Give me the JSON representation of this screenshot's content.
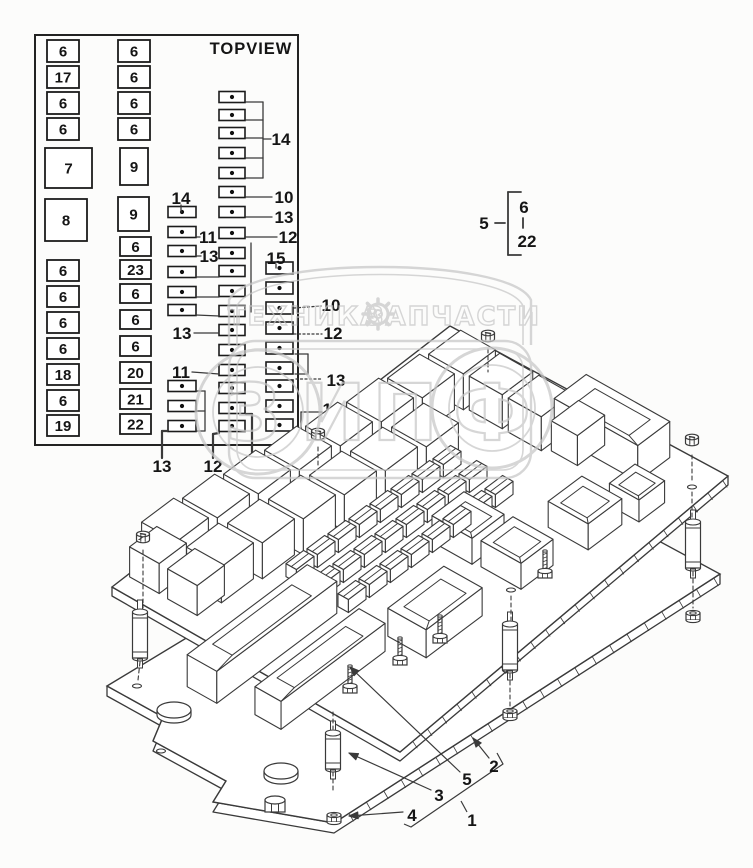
{
  "colors": {
    "bg": "#fcfcfb",
    "line": "#3a3a3a",
    "ink": "#151515",
    "watermark": "#c7c7c7"
  },
  "topview": {
    "title": "TOPVIEW",
    "panel": [
      35,
      35,
      263,
      410
    ],
    "boxes": [
      [
        "6",
        47,
        40,
        32,
        22
      ],
      [
        "17",
        47,
        66,
        32,
        22
      ],
      [
        "6",
        47,
        92,
        32,
        22
      ],
      [
        "6",
        47,
        118,
        32,
        22
      ],
      [
        "7",
        45,
        148,
        47,
        40
      ],
      [
        "8",
        45,
        199,
        42,
        42
      ],
      [
        "6",
        47,
        260,
        32,
        21
      ],
      [
        "6",
        47,
        286,
        32,
        21
      ],
      [
        "6",
        47,
        312,
        32,
        21
      ],
      [
        "6",
        47,
        338,
        32,
        21
      ],
      [
        "18",
        47,
        364,
        32,
        21
      ],
      [
        "6",
        47,
        390,
        32,
        21
      ],
      [
        "19",
        47,
        415,
        32,
        21
      ],
      [
        "6",
        118,
        40,
        32,
        22
      ],
      [
        "6",
        118,
        66,
        32,
        22
      ],
      [
        "6",
        118,
        92,
        32,
        22
      ],
      [
        "6",
        118,
        118,
        32,
        22
      ],
      [
        "9",
        120,
        148,
        28,
        37
      ],
      [
        "9",
        118,
        197,
        31,
        34
      ],
      [
        "6",
        120,
        237,
        31,
        19
      ],
      [
        "23",
        120,
        260,
        31,
        19
      ],
      [
        "6",
        120,
        284,
        31,
        19
      ],
      [
        "6",
        120,
        310,
        31,
        19
      ],
      [
        "6",
        120,
        336,
        31,
        20
      ],
      [
        "20",
        120,
        362,
        31,
        21
      ],
      [
        "21",
        120,
        389,
        31,
        20
      ],
      [
        "22",
        120,
        414,
        31,
        20
      ]
    ],
    "fuses": [
      [
        219,
        97,
        26,
        11
      ],
      [
        219,
        115,
        26,
        11
      ],
      [
        219,
        133,
        26,
        11
      ],
      [
        219,
        153,
        26,
        11
      ],
      [
        219,
        173,
        26,
        11
      ],
      [
        219,
        192,
        26,
        11
      ],
      [
        219,
        212,
        26,
        11
      ],
      [
        219,
        233,
        26,
        11
      ],
      [
        219,
        253,
        26,
        11
      ],
      [
        219,
        271,
        26,
        11
      ],
      [
        219,
        291,
        26,
        11
      ],
      [
        219,
        311,
        26,
        11
      ],
      [
        219,
        330,
        26,
        11
      ],
      [
        219,
        350,
        26,
        11
      ],
      [
        219,
        370,
        26,
        11
      ],
      [
        219,
        388,
        26,
        11
      ],
      [
        219,
        408,
        26,
        11
      ],
      [
        219,
        426,
        26,
        11
      ],
      [
        168,
        212,
        28,
        11
      ],
      [
        168,
        232,
        28,
        11
      ],
      [
        168,
        251,
        28,
        11
      ],
      [
        168,
        272,
        28,
        11
      ],
      [
        168,
        292,
        28,
        11
      ],
      [
        168,
        310,
        28,
        11
      ],
      [
        168,
        386,
        28,
        11
      ],
      [
        168,
        406,
        28,
        11
      ],
      [
        168,
        426,
        28,
        11
      ],
      [
        266,
        268,
        27,
        12
      ],
      [
        266,
        288,
        27,
        12
      ],
      [
        266,
        308,
        27,
        12
      ],
      [
        266,
        328,
        27,
        12
      ],
      [
        266,
        348,
        27,
        12
      ],
      [
        266,
        368,
        27,
        12
      ],
      [
        266,
        386,
        27,
        12
      ],
      [
        266,
        406,
        27,
        12
      ],
      [
        266,
        425,
        27,
        12
      ]
    ],
    "labels": [
      [
        "14",
        281,
        139
      ],
      [
        "10",
        284,
        197
      ],
      [
        "13",
        284,
        217
      ],
      [
        "14",
        181,
        198
      ],
      [
        "11",
        208,
        237
      ],
      [
        "12",
        288,
        237
      ],
      [
        "13",
        209,
        256
      ],
      [
        "15",
        276,
        258
      ],
      [
        "10",
        331,
        305
      ],
      [
        "12",
        333,
        333
      ],
      [
        "13",
        182,
        333
      ],
      [
        "11",
        181,
        372
      ],
      [
        "13",
        336,
        380
      ],
      [
        "16",
        332,
        409
      ],
      [
        "13",
        162,
        466
      ],
      [
        "12",
        213,
        466
      ],
      [
        "14",
        252,
        466
      ]
    ],
    "lines_solid": [
      [
        246,
        102,
        263,
        102
      ],
      [
        246,
        120,
        263,
        120
      ],
      [
        246,
        138,
        263,
        138
      ],
      [
        246,
        158,
        263,
        158
      ],
      [
        246,
        178,
        263,
        178
      ],
      [
        263,
        102,
        263,
        178
      ],
      [
        263,
        139,
        271,
        139
      ],
      [
        246,
        197,
        272,
        197
      ],
      [
        246,
        217,
        272,
        217
      ],
      [
        181,
        205,
        181,
        212
      ],
      [
        196,
        237,
        200,
        237
      ],
      [
        246,
        237,
        277,
        237
      ],
      [
        196,
        256,
        201,
        256
      ],
      [
        276,
        264,
        276,
        268
      ],
      [
        194,
        333,
        219,
        333
      ],
      [
        192,
        372,
        219,
        374
      ],
      [
        322,
        412,
        301,
        412
      ],
      [
        301,
        412,
        301,
        428
      ],
      [
        301,
        428,
        294,
        428
      ],
      [
        196,
        277,
        219,
        277
      ],
      [
        196,
        297,
        219,
        297
      ],
      [
        196,
        315,
        219,
        316
      ],
      [
        205,
        391,
        205,
        431
      ],
      [
        196,
        391,
        205,
        391
      ],
      [
        196,
        411,
        205,
        411
      ],
      [
        196,
        431,
        205,
        431
      ],
      [
        295,
        354,
        308,
        354
      ],
      [
        308,
        354,
        308,
        374
      ],
      [
        308,
        374,
        295,
        374
      ],
      [
        251,
        243,
        251,
        312
      ]
    ],
    "lines_thick": [
      [
        162,
        458,
        162,
        431
      ],
      [
        162,
        431,
        167,
        431
      ],
      [
        213,
        458,
        213,
        434
      ],
      [
        213,
        434,
        219,
        433
      ],
      [
        252,
        458,
        252,
        414
      ],
      [
        252,
        414,
        246,
        414
      ]
    ],
    "lines_dotted": [
      [
        294,
        308,
        321,
        306
      ],
      [
        294,
        334,
        322,
        334
      ],
      [
        296,
        379,
        323,
        379
      ]
    ]
  },
  "callout": {
    "num": "5",
    "lo": "6",
    "hi": "22",
    "num_pos": [
      484,
      223
    ],
    "lo_pos": [
      524,
      207
    ],
    "hi_pos": [
      527,
      241
    ],
    "lines": [
      [
        495,
        223,
        505,
        223
      ],
      [
        508,
        192,
        508,
        255
      ],
      [
        508,
        192,
        521,
        192
      ],
      [
        508,
        255,
        521,
        255
      ],
      [
        523,
        218,
        523,
        228
      ]
    ]
  },
  "iso": {
    "bottom_plate": [
      [
        107,
        686
      ],
      [
        163,
        717
      ],
      [
        153,
        741
      ],
      [
        226,
        781
      ],
      [
        213,
        802
      ],
      [
        334,
        823
      ],
      [
        720,
        574
      ],
      [
        494,
        452
      ]
    ],
    "upper_plate": [
      [
        112,
        587
      ],
      [
        400,
        752
      ],
      [
        728,
        476
      ],
      [
        450,
        326
      ]
    ],
    "cuboids": [
      [
        175,
        520,
        40,
        40,
        36,
        0
      ],
      [
        216,
        496,
        40,
        40,
        36,
        0
      ],
      [
        257,
        472,
        40,
        40,
        36,
        0
      ],
      [
        298,
        448,
        40,
        40,
        36,
        0
      ],
      [
        339,
        424,
        40,
        40,
        36,
        0
      ],
      [
        380,
        400,
        40,
        40,
        36,
        0
      ],
      [
        421,
        376,
        40,
        40,
        36,
        0
      ],
      [
        462,
        352,
        40,
        40,
        36,
        0
      ],
      [
        220,
        545,
        40,
        40,
        36,
        0
      ],
      [
        261,
        521,
        40,
        40,
        36,
        0
      ],
      [
        302,
        497,
        40,
        40,
        36,
        0
      ],
      [
        343,
        473,
        40,
        40,
        36,
        0
      ],
      [
        384,
        449,
        40,
        40,
        36,
        0
      ],
      [
        425,
        425,
        40,
        40,
        36,
        0
      ],
      [
        501,
        374,
        38,
        38,
        34,
        0
      ],
      [
        540,
        396,
        38,
        38,
        34,
        0
      ],
      [
        578,
        418,
        30,
        34,
        30,
        0
      ],
      [
        158,
        545,
        34,
        34,
        30,
        0
      ],
      [
        196,
        567,
        34,
        34,
        30,
        0
      ],
      [
        262,
        618,
        34,
        150,
        32,
        1
      ],
      [
        320,
        655,
        30,
        130,
        28,
        1
      ],
      [
        435,
        598,
        44,
        70,
        28,
        1
      ],
      [
        612,
        410,
        96,
        40,
        36,
        1
      ],
      [
        468,
        515,
        46,
        40,
        26,
        1
      ],
      [
        517,
        540,
        46,
        40,
        26,
        1
      ],
      [
        585,
        500,
        46,
        42,
        26,
        1
      ],
      [
        637,
        482,
        34,
        32,
        22,
        1
      ],
      [
        300,
        560,
        12,
        22,
        13,
        2
      ],
      [
        321,
        545,
        12,
        22,
        13,
        2
      ],
      [
        342,
        530,
        12,
        22,
        13,
        2
      ],
      [
        363,
        515,
        12,
        22,
        13,
        2
      ],
      [
        384,
        500,
        12,
        22,
        13,
        2
      ],
      [
        405,
        485,
        12,
        22,
        13,
        2
      ],
      [
        426,
        470,
        12,
        22,
        13,
        2
      ],
      [
        447,
        455,
        12,
        22,
        13,
        2
      ],
      [
        326,
        575,
        12,
        22,
        13,
        2
      ],
      [
        347,
        560,
        12,
        22,
        13,
        2
      ],
      [
        368,
        545,
        12,
        22,
        13,
        2
      ],
      [
        389,
        530,
        12,
        22,
        13,
        2
      ],
      [
        410,
        515,
        12,
        22,
        13,
        2
      ],
      [
        431,
        500,
        12,
        22,
        13,
        2
      ],
      [
        452,
        485,
        12,
        22,
        13,
        2
      ],
      [
        473,
        470,
        12,
        22,
        13,
        2
      ],
      [
        352,
        590,
        12,
        22,
        13,
        2
      ],
      [
        373,
        575,
        12,
        22,
        13,
        2
      ],
      [
        394,
        560,
        12,
        22,
        13,
        2
      ],
      [
        415,
        545,
        12,
        22,
        13,
        2
      ],
      [
        436,
        530,
        12,
        22,
        13,
        2
      ],
      [
        457,
        515,
        12,
        22,
        13,
        2
      ],
      [
        478,
        500,
        12,
        22,
        13,
        2
      ],
      [
        499,
        485,
        12,
        22,
        13,
        2
      ]
    ],
    "studs": [
      [
        350,
        690
      ],
      [
        400,
        662
      ],
      [
        440,
        640
      ],
      [
        545,
        575
      ]
    ],
    "standoffs": [
      [
        140,
        612,
        46
      ],
      [
        693,
        522,
        46
      ],
      [
        510,
        624,
        46
      ],
      [
        333,
        733,
        36
      ]
    ],
    "bolts": [
      [
        143,
        538
      ],
      [
        318,
        435
      ],
      [
        488,
        337
      ],
      [
        692,
        441
      ]
    ],
    "nuts": [
      [
        693,
        616
      ],
      [
        510,
        714
      ],
      [
        334,
        818
      ]
    ],
    "plate_bolt": [
      275,
      806
    ],
    "holes_upper": [
      [
        511,
        590
      ],
      [
        692,
        487
      ]
    ],
    "holes_lower": [
      [
        137,
        686
      ],
      [
        161,
        751
      ]
    ],
    "bumps": [
      [
        174,
        710
      ],
      [
        281,
        771
      ]
    ],
    "dashes": [
      [
        143,
        550,
        143,
        608
      ],
      [
        140,
        662,
        138,
        680
      ],
      [
        318,
        447,
        318,
        468
      ],
      [
        488,
        349,
        488,
        372
      ],
      [
        692,
        455,
        692,
        482
      ],
      [
        692,
        492,
        692,
        518
      ],
      [
        693,
        572,
        693,
        608
      ],
      [
        511,
        596,
        511,
        620
      ],
      [
        510,
        674,
        510,
        706
      ],
      [
        333,
        712,
        333,
        729
      ],
      [
        333,
        772,
        333,
        790
      ]
    ],
    "labels": [
      [
        "2",
        494,
        766
      ],
      [
        "5",
        467,
        779
      ],
      [
        "3",
        439,
        795
      ],
      [
        "4",
        412,
        815
      ],
      [
        "1",
        472,
        820
      ]
    ],
    "leaders": [
      [
        [
          460,
          772
        ],
        [
          350,
          667
        ]
      ],
      [
        [
          489,
          758
        ],
        [
          473,
          738
        ]
      ],
      [
        [
          431,
          790
        ],
        [
          349,
          753
        ]
      ],
      [
        [
          403,
          812
        ],
        [
          349,
          816
        ]
      ]
    ],
    "brackets": [
      [
        [
          404,
          824
        ],
        [
          411,
          827
        ],
        [
          503,
          764
        ],
        [
          497,
          753
        ]
      ],
      [
        [
          467,
          812
        ],
        [
          461,
          801
        ]
      ]
    ]
  },
  "watermark": {
    "left_text": "ТЕХНИКА",
    "right_text": "ЗАПЧАСТИ",
    "left_pos": [
      305,
      325
    ],
    "right_pos": [
      453,
      325
    ],
    "gear_pos": [
      378,
      314
    ],
    "letters": [
      [
        "З",
        253
      ],
      [
        "И",
        333
      ],
      [
        "П",
        405
      ],
      [
        "Ф",
        492
      ]
    ],
    "letter_baseline": 440,
    "circles": [
      [
        258,
        412,
        62
      ],
      [
        258,
        412,
        45
      ],
      [
        492,
        408,
        60
      ],
      [
        492,
        408,
        43
      ]
    ]
  }
}
